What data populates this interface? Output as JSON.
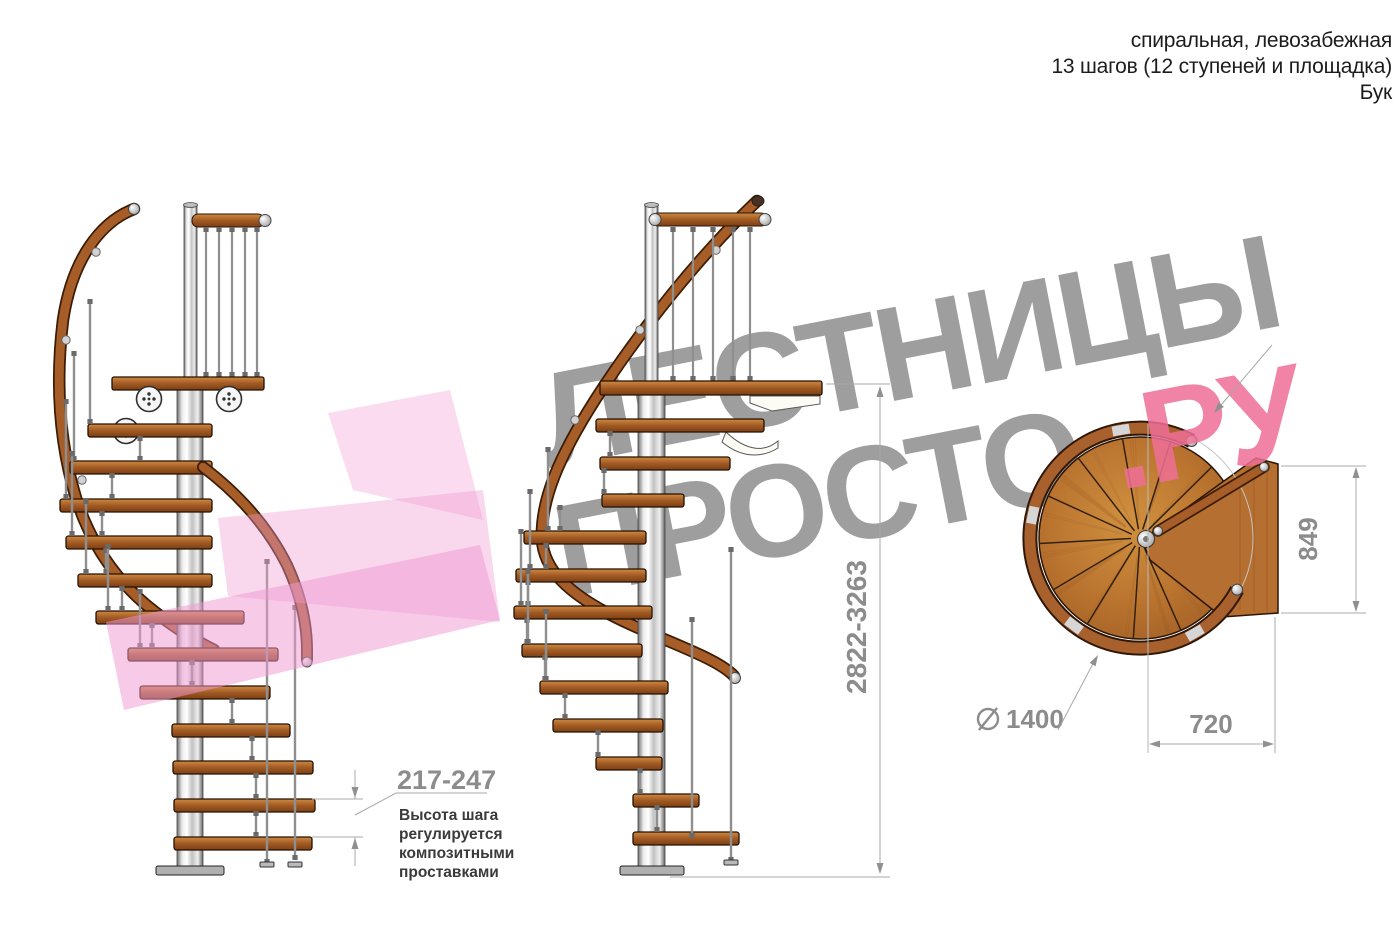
{
  "header": {
    "line1": "спиральная, левозабежная",
    "line2": "13 шагов (12 ступеней и площадка)",
    "line3": "Бук"
  },
  "watermark": {
    "line1": "ЛЕСТНИЦЫ",
    "line2_gray": "ПРОСТО",
    "line2_pink": ".РУ",
    "gray_color": "#9e9e9e",
    "pink_color": "#ee6e96"
  },
  "annotations": {
    "step_height": "217-247",
    "step_note": [
      "Высота шага",
      "регулируется",
      "композитными",
      "проставками"
    ],
    "total_height": "2822-3263",
    "platform_width": "849",
    "platform_depth": "720",
    "diameter_value": "1400"
  },
  "colors": {
    "wood": "#a75d28",
    "wood_dark": "#2b1605",
    "metal": "#cfcfcf",
    "dimension": "#8c8c8c",
    "pink_arrow": "#f09ad2"
  }
}
